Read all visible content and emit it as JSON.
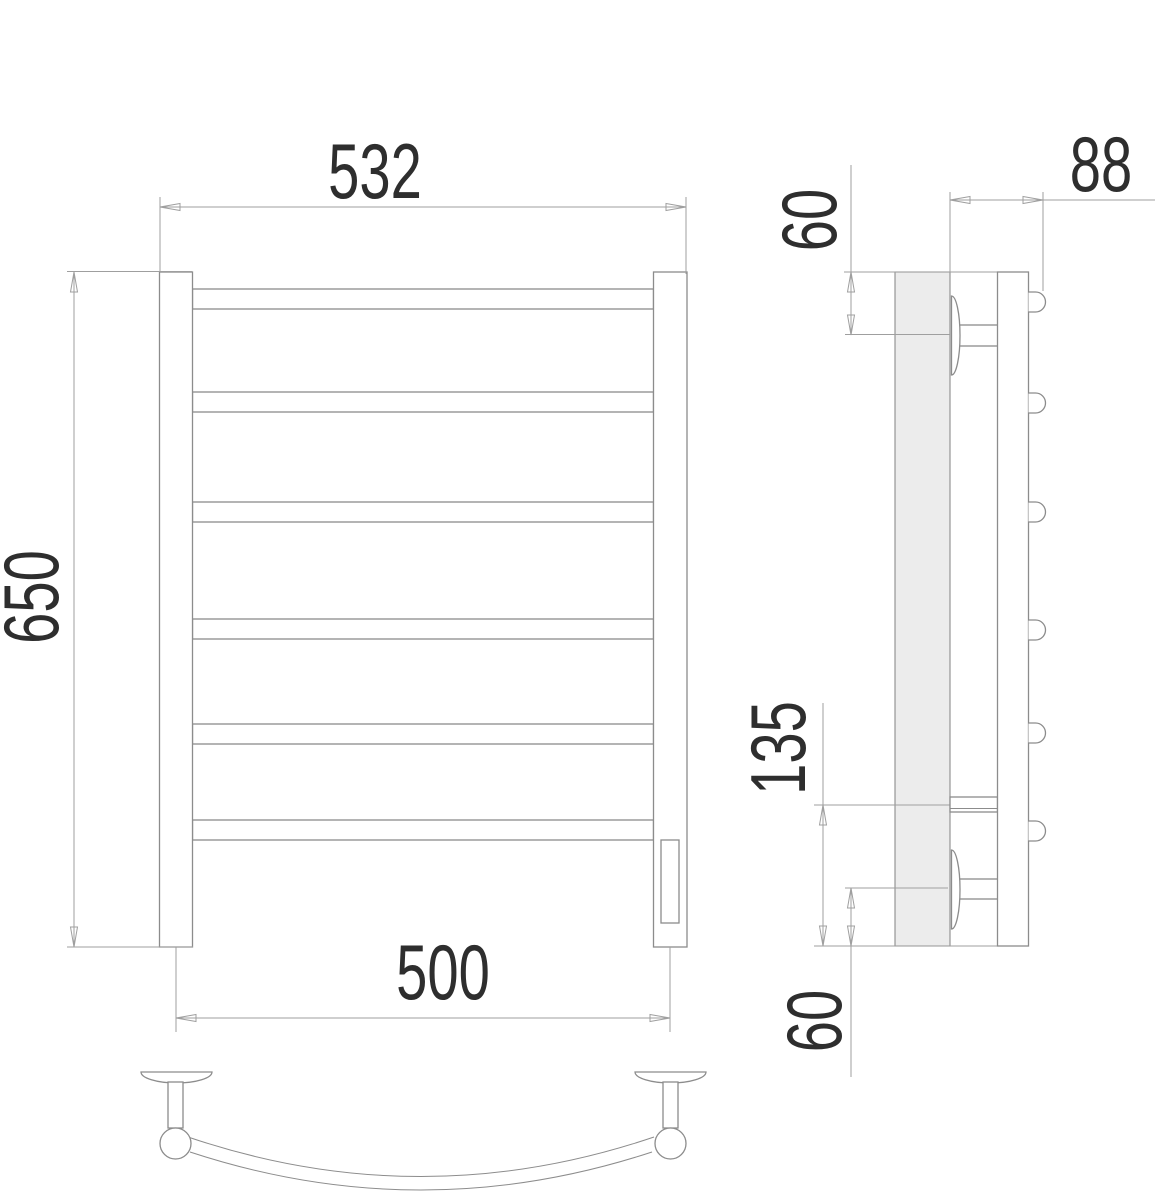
{
  "dimensions": {
    "front_width": "532",
    "front_height": "650",
    "bottom_axis_width": "500",
    "side_depth": "88",
    "side_top_offset": "60",
    "side_connection_height": "135",
    "side_bottom_offset": "60"
  },
  "structure": {
    "rail_count": 6,
    "bracket_count": 2
  },
  "colors": {
    "line": "#8c8c8c",
    "dim-line": "#9f9f9f",
    "text-color": "#2e2e2e",
    "wall-fill": "#ececec"
  }
}
